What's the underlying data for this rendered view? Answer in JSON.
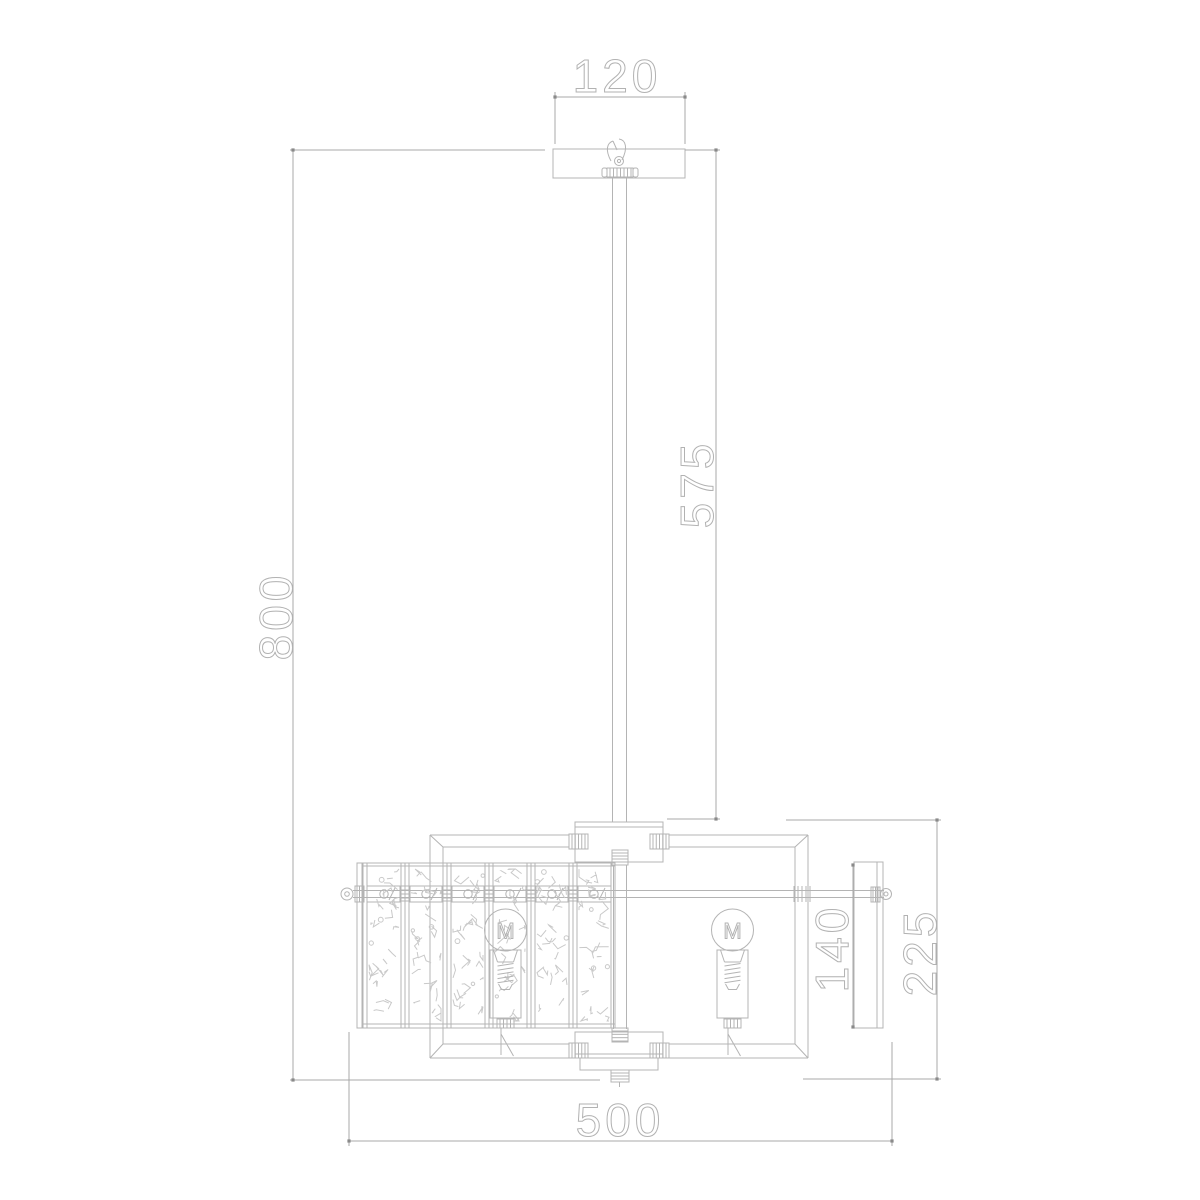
{
  "dimensions": {
    "canopy_width": "120",
    "overall_drop": "800",
    "rod_length": "575",
    "body_height": "225",
    "crystal_panel_height": "140",
    "body_width": "500"
  },
  "symbols": {
    "bulb_filament": "M"
  },
  "colors": {
    "background": "#ffffff",
    "line": "#b4b4b4",
    "dimension_line": "#a9a9a9",
    "tick": "#8a8a8a",
    "texture": "#c9c9c9",
    "text_stroke": "#b2b2b2"
  }
}
